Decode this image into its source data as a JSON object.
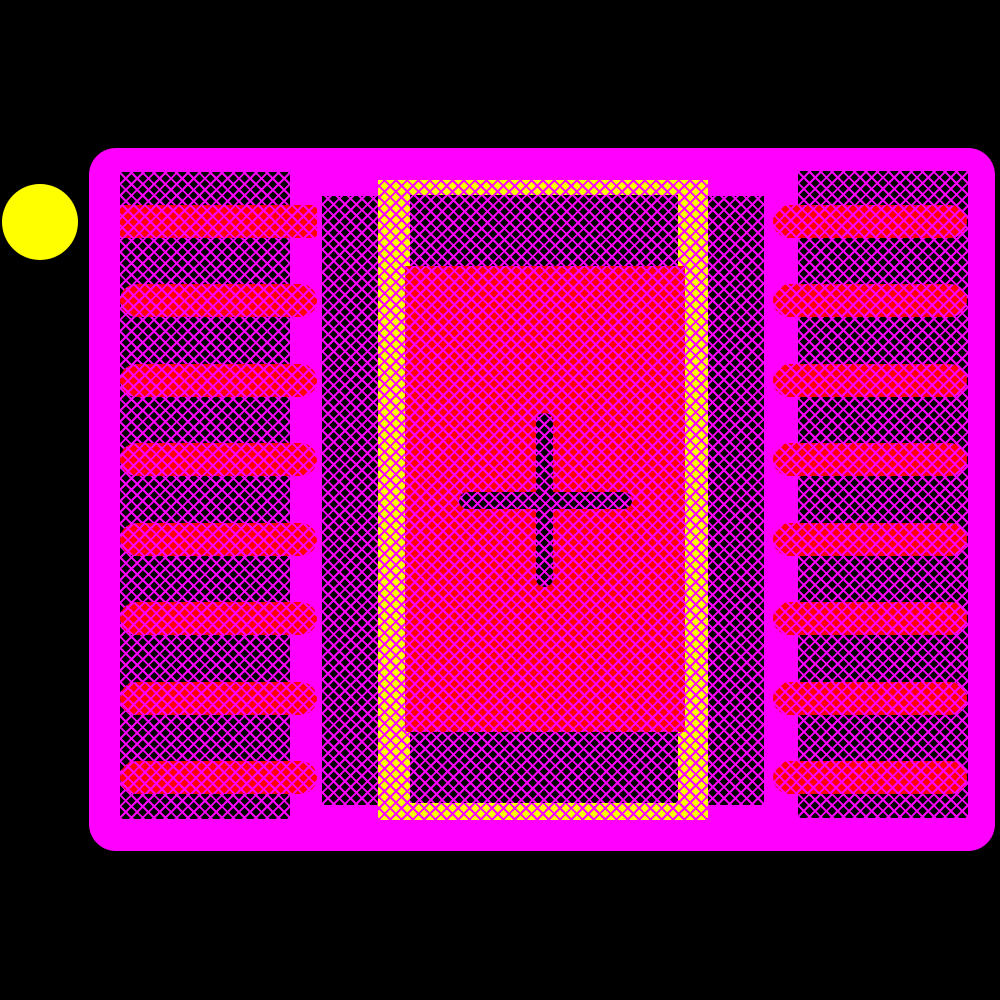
{
  "scene": {
    "colors": {
      "background": "#000000",
      "courtyard": "#ff00ff",
      "lattice": "#ff00ff",
      "dark_base": "#000000",
      "pad_red": "#ff0008",
      "frame_yellow": "#ffff00",
      "pin1_marker": "#ffff00"
    },
    "courtyard_rect": {
      "x": 89,
      "y": 148,
      "w": 906,
      "h": 703,
      "r": 27
    },
    "pin1_marker": {
      "cx": 40,
      "cy": 222,
      "r": 38
    },
    "left_mask": {
      "x": 120,
      "y": 172,
      "w": 170,
      "h": 647
    },
    "right_mask": {
      "x": 798,
      "y": 171,
      "w": 170,
      "h": 647
    },
    "center_mask": {
      "x": 322,
      "y": 196,
      "w": 442,
      "h": 609
    },
    "paste_frame_outer": {
      "x": 378,
      "y": 180,
      "w": 330,
      "h": 640
    },
    "paste_frame_inner": {
      "x": 410,
      "y": 195,
      "w": 268,
      "h": 608
    },
    "thermal_pad": {
      "x": 405,
      "y": 266,
      "w": 280,
      "h": 466
    },
    "origin_cross": {
      "vertical": {
        "x": 536,
        "y": 413,
        "w": 17,
        "h": 174
      },
      "horizontal": {
        "x": 459,
        "y": 492,
        "w": 173,
        "h": 17
      }
    },
    "left_pads": {
      "x": 120,
      "w": 197,
      "h": 33,
      "tops": [
        205,
        284,
        364,
        443,
        523,
        602,
        682,
        761
      ],
      "first_square": true
    },
    "right_pads": {
      "x": 773,
      "w": 194,
      "h": 33,
      "tops": [
        205,
        284,
        364,
        443,
        523,
        602,
        682,
        761
      ],
      "first_square": false
    }
  }
}
